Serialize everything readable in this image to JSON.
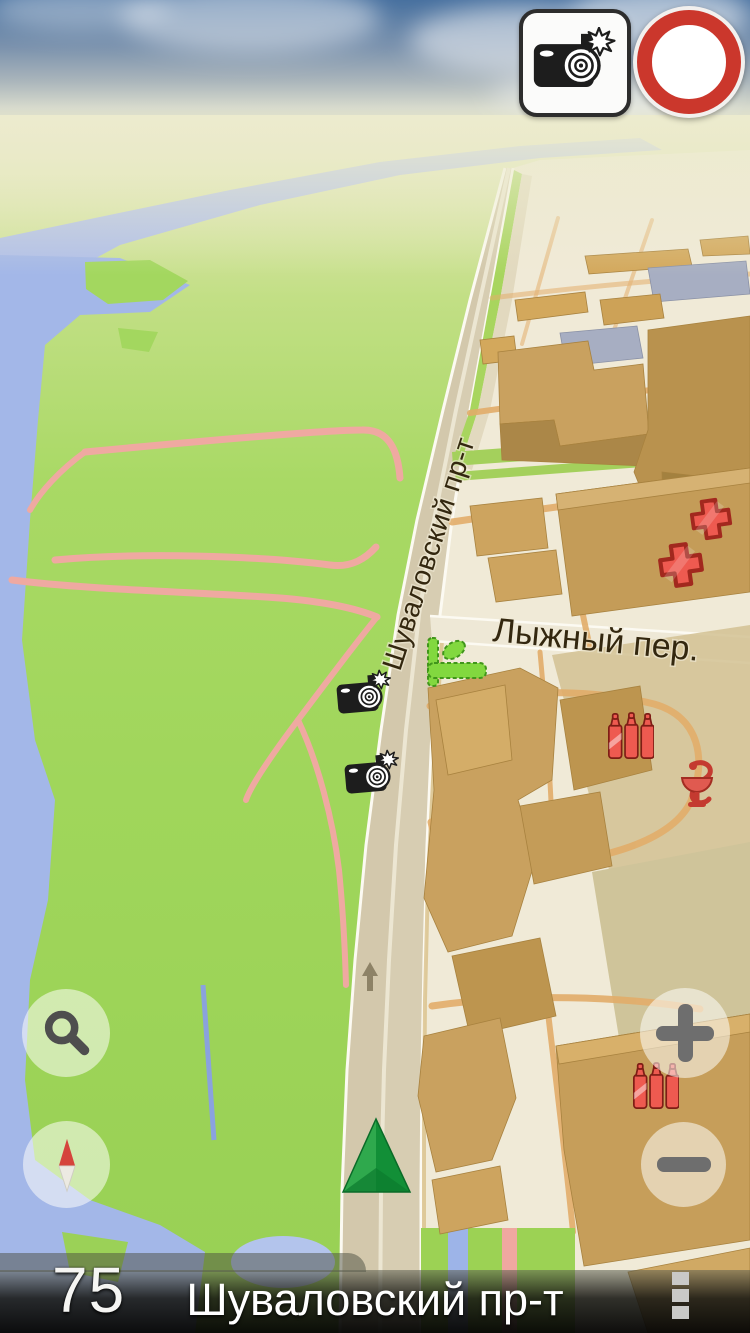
{
  "screen": {
    "width": 750,
    "height": 1333,
    "app_type": "gps-navigation-3d-map"
  },
  "top_bar": {
    "camera_warning_button": {
      "icon": "speed-camera-flash-icon"
    },
    "speed_limit_sign": {
      "value": "60"
    }
  },
  "map": {
    "street_labels": {
      "main_road": "Шуваловский пр-т",
      "side_street": "Лыжный пер."
    },
    "poi_icons": [
      {
        "name": "speed-camera-icon",
        "location": "main-road-upper"
      },
      {
        "name": "speed-camera-icon",
        "location": "main-road-lower"
      },
      {
        "name": "hotel-bed-icon",
        "location": "side-street-corner"
      },
      {
        "name": "pharmacy-cross-icon",
        "location": "upper-right-block-1"
      },
      {
        "name": "pharmacy-cross-icon",
        "location": "upper-right-block-2"
      },
      {
        "name": "bottles-icon",
        "location": "middle-block"
      },
      {
        "name": "snake-bowl-icon",
        "location": "middle-right-block"
      },
      {
        "name": "bottles-icon",
        "location": "lower-right-block"
      },
      {
        "name": "direction-arrow-icon",
        "location": "main-road-bottom"
      }
    ],
    "position_marker": {
      "name": "vehicle-marker",
      "shape": "green-pyramid"
    }
  },
  "controls": {
    "search_button": {
      "icon": "magnifier-icon"
    },
    "compass_button": {
      "icon": "compass-needle-icon"
    },
    "zoom_in_button": {
      "label": "+"
    },
    "zoom_out_button": {
      "label": "−"
    }
  },
  "status_bar": {
    "speed": "75",
    "street": "Шуваловский пр-т",
    "menu_button": {
      "icon": "vertical-dots-icon"
    }
  },
  "colors": {
    "sky_top": "#47709f",
    "horizon": "#edecca",
    "land_green": "#a3d75f",
    "water": "#a3b7e8",
    "urban_ground": "#f0ead7",
    "building_tan": "#c9a15f",
    "road_surface": "#d7cdb2",
    "path_pink": "#efa9a1",
    "path_orange": "#e2ad6a",
    "poi_red": "#ee5a50",
    "poi_green": "#82d83f",
    "marker_green": "#1f9e41",
    "sign_ring_red": "#cb372c",
    "bar_dark": "#141412"
  }
}
